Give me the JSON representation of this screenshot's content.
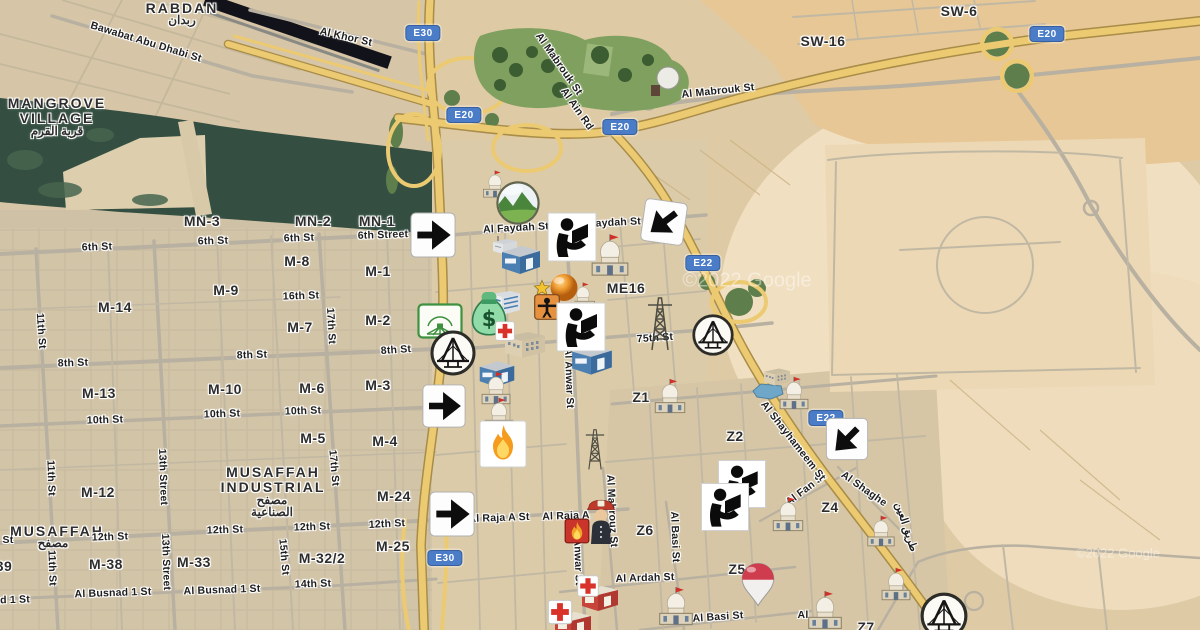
{
  "map": {
    "watermarks": [
      {
        "text": "©2022 Google",
        "x": 747,
        "y": 281,
        "size": 20
      },
      {
        "text": "©2022 Google",
        "x": 1118,
        "y": 553,
        "size": 13
      }
    ],
    "area_labels": [
      {
        "text": "RABDAN",
        "x": 182,
        "y": 8
      },
      {
        "text": "ربدان",
        "x": 182,
        "y": 20,
        "ar": true
      },
      {
        "text": "MANGROVE",
        "x": 57,
        "y": 103
      },
      {
        "text": "VILLAGE",
        "x": 57,
        "y": 118
      },
      {
        "text": "قرية القرم",
        "x": 57,
        "y": 131,
        "ar": true
      },
      {
        "text": "MUSAFFAH",
        "x": 273,
        "y": 472
      },
      {
        "text": "INDUSTRIAL",
        "x": 273,
        "y": 487
      },
      {
        "text": "مصفح",
        "x": 272,
        "y": 500,
        "ar": true
      },
      {
        "text": "الصناعية",
        "x": 272,
        "y": 512,
        "ar": true
      },
      {
        "text": "MUSAFFAH",
        "x": 57,
        "y": 531
      },
      {
        "text": "مصفح",
        "x": 53,
        "y": 543,
        "ar": true
      }
    ],
    "district_labels": [
      {
        "text": "MN-3",
        "x": 202,
        "y": 221
      },
      {
        "text": "MN-2",
        "x": 313,
        "y": 221
      },
      {
        "text": "MN-1",
        "x": 377,
        "y": 221
      },
      {
        "text": "M-8",
        "x": 297,
        "y": 261
      },
      {
        "text": "M-1",
        "x": 378,
        "y": 271
      },
      {
        "text": "M-9",
        "x": 226,
        "y": 290
      },
      {
        "text": "M-14",
        "x": 115,
        "y": 307
      },
      {
        "text": "M-7",
        "x": 300,
        "y": 327
      },
      {
        "text": "M-2",
        "x": 378,
        "y": 320
      },
      {
        "text": "M-13",
        "x": 99,
        "y": 393
      },
      {
        "text": "M-10",
        "x": 225,
        "y": 389
      },
      {
        "text": "M-6",
        "x": 312,
        "y": 388
      },
      {
        "text": "M-3",
        "x": 378,
        "y": 385
      },
      {
        "text": "M-5",
        "x": 313,
        "y": 438
      },
      {
        "text": "M-4",
        "x": 385,
        "y": 441
      },
      {
        "text": "M-12",
        "x": 98,
        "y": 492
      },
      {
        "text": "M-24",
        "x": 394,
        "y": 496
      },
      {
        "text": "M-38",
        "x": 106,
        "y": 564
      },
      {
        "text": "M-33",
        "x": 194,
        "y": 562
      },
      {
        "text": "M-32/2",
        "x": 322,
        "y": 558
      },
      {
        "text": "M-25",
        "x": 393,
        "y": 546
      },
      {
        "text": "39",
        "x": 4,
        "y": 566
      },
      {
        "text": "SW-16",
        "x": 823,
        "y": 41
      },
      {
        "text": "SW-6",
        "x": 959,
        "y": 11
      },
      {
        "text": "ME16",
        "x": 626,
        "y": 288
      },
      {
        "text": "Z1",
        "x": 641,
        "y": 397
      },
      {
        "text": "Z2",
        "x": 735,
        "y": 436
      },
      {
        "text": "Z4",
        "x": 830,
        "y": 507
      },
      {
        "text": "Z6",
        "x": 645,
        "y": 530
      },
      {
        "text": "Z5",
        "x": 737,
        "y": 569
      },
      {
        "text": "Z7",
        "x": 866,
        "y": 627
      }
    ],
    "street_labels": [
      {
        "text": "Bawabat Abu Dhabi St",
        "x": 146,
        "y": 42,
        "rot": 17
      },
      {
        "text": "Al Khor St",
        "x": 346,
        "y": 37,
        "rot": 13
      },
      {
        "text": "Al Mabrouk St",
        "x": 559,
        "y": 64,
        "rot": 55
      },
      {
        "text": "Al Ain Rd",
        "x": 577,
        "y": 109,
        "rot": 55
      },
      {
        "text": "Al Mabrouk St",
        "x": 718,
        "y": 91,
        "rot": -6
      },
      {
        "text": "Al Faydah St",
        "x": 516,
        "y": 228,
        "rot": -3
      },
      {
        "text": "Al Faydah St",
        "x": 608,
        "y": 223,
        "rot": -3
      },
      {
        "text": "6th St",
        "x": 97,
        "y": 247,
        "rot": -2
      },
      {
        "text": "6th St",
        "x": 213,
        "y": 241,
        "rot": -2
      },
      {
        "text": "6th St",
        "x": 299,
        "y": 238,
        "rot": -2
      },
      {
        "text": "6th Street",
        "x": 383,
        "y": 235,
        "rot": -2
      },
      {
        "text": "16th St",
        "x": 301,
        "y": 296,
        "rot": -2
      },
      {
        "text": "17th St",
        "x": 331,
        "y": 326,
        "rot": 87
      },
      {
        "text": "11th St",
        "x": 41,
        "y": 331,
        "rot": 86
      },
      {
        "text": "8th St",
        "x": 73,
        "y": 363,
        "rot": -2
      },
      {
        "text": "8th St",
        "x": 252,
        "y": 355,
        "rot": -2
      },
      {
        "text": "8th St",
        "x": 396,
        "y": 350,
        "rot": -4
      },
      {
        "text": "10th St",
        "x": 105,
        "y": 420,
        "rot": -2
      },
      {
        "text": "10th St",
        "x": 222,
        "y": 414,
        "rot": -2
      },
      {
        "text": "10th St",
        "x": 303,
        "y": 411,
        "rot": -2
      },
      {
        "text": "75th St",
        "x": 655,
        "y": 338,
        "rot": -4
      },
      {
        "text": "Al Anwar St",
        "x": 569,
        "y": 378,
        "rot": 88
      },
      {
        "text": "12th St",
        "x": 110,
        "y": 537,
        "rot": -2
      },
      {
        "text": "12th St",
        "x": 225,
        "y": 530,
        "rot": -2
      },
      {
        "text": "12th St",
        "x": 312,
        "y": 527,
        "rot": -2
      },
      {
        "text": "12th St",
        "x": 387,
        "y": 524,
        "rot": -3
      },
      {
        "text": "13th Street",
        "x": 163,
        "y": 477,
        "rot": 88
      },
      {
        "text": "13th Street",
        "x": 166,
        "y": 562,
        "rot": 88
      },
      {
        "text": "11th St",
        "x": 51,
        "y": 478,
        "rot": 88
      },
      {
        "text": "11th St",
        "x": 52,
        "y": 568,
        "rot": 88
      },
      {
        "text": "17th St",
        "x": 334,
        "y": 468,
        "rot": 85
      },
      {
        "text": "15th St",
        "x": 284,
        "y": 557,
        "rot": 85
      },
      {
        "text": "14th St",
        "x": 313,
        "y": 584,
        "rot": -2
      },
      {
        "text": "Al Busnad 1 St",
        "x": 113,
        "y": 593,
        "rot": -2
      },
      {
        "text": "Al Busnad 1 St",
        "x": 222,
        "y": 590,
        "rot": -2
      },
      {
        "text": "ad 1 St",
        "x": 12,
        "y": 600,
        "rot": -2
      },
      {
        "text": "St",
        "x": 8,
        "y": 540,
        "rot": 0
      },
      {
        "text": "Al Raja A St",
        "x": 499,
        "y": 518,
        "rot": -2
      },
      {
        "text": "Al Raja A",
        "x": 566,
        "y": 516,
        "rot": -2
      },
      {
        "text": "Al Mahrouz St",
        "x": 612,
        "y": 511,
        "rot": 87
      },
      {
        "text": "Anwar St",
        "x": 578,
        "y": 562,
        "rot": 88
      },
      {
        "text": "Al Ardah St",
        "x": 645,
        "y": 578,
        "rot": -2
      },
      {
        "text": "Al Basi St",
        "x": 675,
        "y": 537,
        "rot": 88
      },
      {
        "text": "Al Basi St",
        "x": 718,
        "y": 617,
        "rot": -4
      },
      {
        "text": "Al",
        "x": 803,
        "y": 615,
        "rot": 0
      },
      {
        "text": "Al Fan St",
        "x": 806,
        "y": 489,
        "rot": -37
      },
      {
        "text": "Al Shaghe",
        "x": 864,
        "y": 489,
        "rot": 35
      },
      {
        "text": "Al Shayhameem St",
        "x": 793,
        "y": 441,
        "rot": 52
      },
      {
        "text": "طريق العين",
        "x": 906,
        "y": 527,
        "rot": 72,
        "ar": true
      }
    ],
    "shields": [
      {
        "text": "E30",
        "x": 423,
        "y": 33
      },
      {
        "text": "E20",
        "x": 464,
        "y": 115
      },
      {
        "text": "E20",
        "x": 620,
        "y": 127
      },
      {
        "text": "E20",
        "x": 1047,
        "y": 34
      },
      {
        "text": "E22",
        "x": 703,
        "y": 263
      },
      {
        "text": "E22",
        "x": 826,
        "y": 418
      },
      {
        "text": "E30",
        "x": 445,
        "y": 558
      }
    ],
    "markers": [
      {
        "t": "pond",
        "n": "pond",
        "x": 768,
        "y": 391,
        "w": 34,
        "h": 18
      },
      {
        "t": "pylon",
        "n": "power-pylon-icon",
        "x": 660,
        "y": 322,
        "w": 34,
        "h": 60
      },
      {
        "t": "pylon",
        "n": "power-pylon-icon",
        "x": 595,
        "y": 448,
        "w": 26,
        "h": 46
      },
      {
        "t": "bldggray",
        "n": "antenna-building-icon",
        "x": 505,
        "y": 245,
        "w": 28,
        "h": 22
      },
      {
        "t": "factory",
        "n": "warehouse-icon",
        "x": 521,
        "y": 260,
        "w": 44,
        "h": 34
      },
      {
        "t": "office",
        "n": "office-building-icon",
        "x": 506,
        "y": 303,
        "w": 32,
        "h": 28
      },
      {
        "t": "bldgtan",
        "n": "building-icon",
        "x": 525,
        "y": 345,
        "w": 46,
        "h": 32
      },
      {
        "t": "factory",
        "n": "warehouse-icon",
        "x": 497,
        "y": 374,
        "w": 40,
        "h": 31
      },
      {
        "t": "factory",
        "n": "warehouse-icon",
        "x": 592,
        "y": 360,
        "w": 46,
        "h": 36
      },
      {
        "t": "bldgtan",
        "n": "building-icon",
        "x": 777,
        "y": 377,
        "w": 30,
        "h": 22
      },
      {
        "t": "firehouse",
        "n": "fire-station-building-icon",
        "x": 600,
        "y": 598,
        "w": 40,
        "h": 30
      },
      {
        "t": "firehouse",
        "n": "fire-station-building-icon",
        "x": 573,
        "y": 624,
        "w": 40,
        "h": 30
      },
      {
        "t": "mosque",
        "n": "mosque-icon",
        "x": 495,
        "y": 184,
        "w": 30,
        "h": 30
      },
      {
        "t": "mosque",
        "n": "mosque-icon",
        "x": 583,
        "y": 296,
        "w": 30,
        "h": 30
      },
      {
        "t": "mosque",
        "n": "mosque-icon",
        "x": 610,
        "y": 255,
        "w": 46,
        "h": 46
      },
      {
        "t": "mosque",
        "n": "mosque-icon",
        "x": 496,
        "y": 388,
        "w": 36,
        "h": 36
      },
      {
        "t": "mosque",
        "n": "mosque-icon",
        "x": 499,
        "y": 414,
        "w": 36,
        "h": 36
      },
      {
        "t": "mosque",
        "n": "mosque-icon",
        "x": 670,
        "y": 396,
        "w": 38,
        "h": 38
      },
      {
        "t": "mosque",
        "n": "mosque-icon",
        "x": 794,
        "y": 393,
        "w": 36,
        "h": 36
      },
      {
        "t": "mosque",
        "n": "mosque-icon",
        "x": 788,
        "y": 514,
        "w": 38,
        "h": 38
      },
      {
        "t": "mosque",
        "n": "mosque-icon",
        "x": 881,
        "y": 531,
        "w": 34,
        "h": 34
      },
      {
        "t": "mosque",
        "n": "mosque-icon",
        "x": 896,
        "y": 584,
        "w": 36,
        "h": 36
      },
      {
        "t": "mosque",
        "n": "mosque-icon",
        "x": 676,
        "y": 606,
        "w": 42,
        "h": 42
      },
      {
        "t": "mosque",
        "n": "mosque-icon",
        "x": 825,
        "y": 610,
        "w": 42,
        "h": 42
      },
      {
        "t": "globe",
        "n": "landscape-globe-icon",
        "x": 518,
        "y": 203,
        "w": 44,
        "h": 44
      },
      {
        "t": "venue",
        "n": "amphitheater-icon",
        "x": 440,
        "y": 321,
        "w": 46,
        "h": 36
      },
      {
        "t": "moneybag",
        "n": "money-bag-icon",
        "x": 489,
        "y": 313,
        "w": 42,
        "h": 48
      },
      {
        "t": "cross",
        "n": "hospital-cross-icon",
        "x": 505,
        "y": 331,
        "w": 20,
        "h": 20
      },
      {
        "t": "bridge",
        "n": "bridge-icon",
        "x": 453,
        "y": 353,
        "w": 48,
        "h": 48
      },
      {
        "t": "bridge",
        "n": "bridge-icon",
        "x": 713,
        "y": 335,
        "w": 44,
        "h": 44
      },
      {
        "t": "bridge",
        "n": "bridge-icon",
        "x": 944,
        "y": 616,
        "w": 50,
        "h": 50
      },
      {
        "t": "dome",
        "n": "orange-dome-icon",
        "x": 564,
        "y": 289,
        "w": 36,
        "h": 34
      },
      {
        "t": "star",
        "n": "star-icon",
        "x": 542,
        "y": 288,
        "w": 17,
        "h": 17
      },
      {
        "t": "guard",
        "n": "crossing-guard-icon",
        "x": 547,
        "y": 307,
        "w": 26,
        "h": 26
      },
      {
        "t": "fire",
        "n": "fire-icon",
        "x": 503,
        "y": 444,
        "w": 48,
        "h": 48
      },
      {
        "t": "flamebadge",
        "n": "flame-badge-icon",
        "x": 577,
        "y": 531,
        "w": 25,
        "h": 25
      },
      {
        "t": "fireman",
        "n": "fireman-icon",
        "x": 601,
        "y": 519,
        "w": 32,
        "h": 50
      },
      {
        "t": "cross",
        "n": "hospital-cross-icon",
        "x": 588,
        "y": 586,
        "w": 22,
        "h": 22
      },
      {
        "t": "cross",
        "n": "hospital-cross-icon",
        "x": 560,
        "y": 612,
        "w": 25,
        "h": 25
      },
      {
        "t": "flagpin",
        "n": "flag-pin-icon",
        "x": 758,
        "y": 585,
        "w": 38,
        "h": 46
      },
      {
        "t": "arrowr",
        "n": "turn-right-arrow-icon",
        "x": 433,
        "y": 235,
        "w": 47,
        "h": 47
      },
      {
        "t": "arrowr",
        "n": "turn-right-arrow-icon",
        "x": 444,
        "y": 406,
        "w": 45,
        "h": 45
      },
      {
        "t": "arrowr",
        "n": "turn-right-arrow-icon",
        "x": 452,
        "y": 514,
        "w": 47,
        "h": 47
      },
      {
        "t": "arrowdl",
        "n": "turn-down-left-arrow-icon",
        "x": 664,
        "y": 222,
        "w": 45,
        "h": 45,
        "r": 8
      },
      {
        "t": "arrowdl",
        "n": "turn-down-left-arrow-icon",
        "x": 847,
        "y": 439,
        "w": 44,
        "h": 44
      },
      {
        "t": "library",
        "n": "library-icon",
        "x": 572,
        "y": 237,
        "w": 50,
        "h": 50
      },
      {
        "t": "library",
        "n": "library-icon",
        "x": 581,
        "y": 327,
        "w": 50,
        "h": 50
      },
      {
        "t": "library",
        "n": "library-icon",
        "x": 742,
        "y": 484,
        "w": 49,
        "h": 49
      },
      {
        "t": "library",
        "n": "library-icon",
        "x": 725,
        "y": 507,
        "w": 49,
        "h": 49
      }
    ]
  }
}
